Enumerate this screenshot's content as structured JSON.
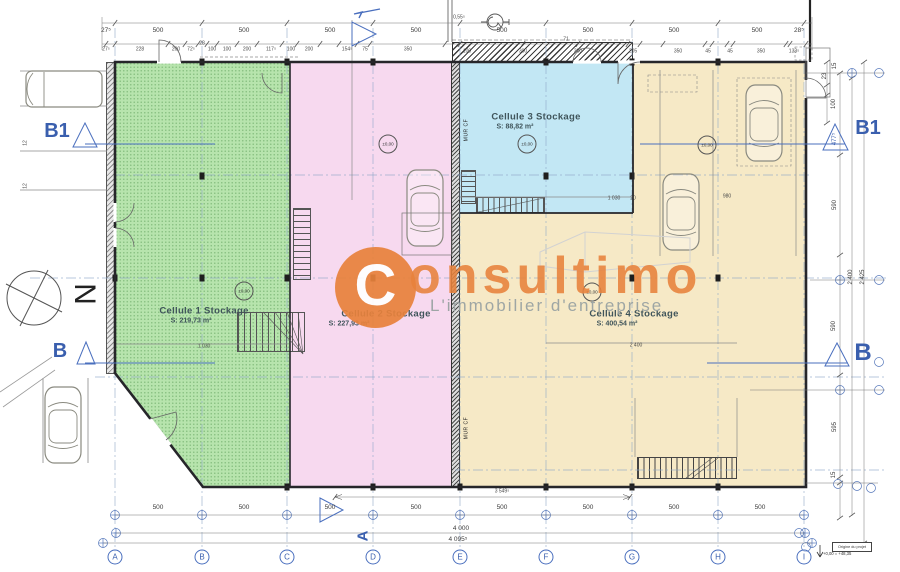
{
  "watermark": {
    "logo_letter": "C",
    "brand": "onsultimo",
    "tagline": "L'immobilier d'entreprise"
  },
  "compass": {
    "letter": "N"
  },
  "levels_label": "±0,00",
  "title_block": {
    "origin_label": "Origine du projet",
    "origin_level": "+0,00 = +48,35"
  },
  "cells": [
    {
      "id": 1,
      "label": "Cellule 1 Stockage",
      "area": "S: 219,73 m²",
      "color": "#b7e4ad"
    },
    {
      "id": 2,
      "label": "Cellule 2 Stockage",
      "area": "S: 227,93 m²",
      "color": "#f7d9ef"
    },
    {
      "id": 3,
      "label": "Cellule 3 Stockage",
      "area": "S: 88,82 m²",
      "color": "#c2e7f4"
    },
    {
      "id": 4,
      "label": "Cellule 4 Stockage",
      "area": "S: 400,54 m²",
      "color": "#f6e9c6"
    }
  ],
  "grid": {
    "letters": [
      "A",
      "B",
      "C",
      "D",
      "E",
      "F",
      "G",
      "H",
      "I"
    ],
    "xs": [
      115,
      202,
      287,
      373,
      460,
      546,
      632,
      718,
      804
    ],
    "y": 557
  },
  "level_badges": [
    [
      244,
      291
    ],
    [
      388,
      144
    ],
    [
      527,
      144
    ],
    [
      707,
      145
    ],
    [
      592,
      292
    ]
  ],
  "labels": [
    {
      "t": "27⁵",
      "x": 106,
      "y": 31,
      "c": "d"
    },
    {
      "t": "500",
      "x": 158,
      "y": 31,
      "c": "d"
    },
    {
      "t": "500",
      "x": 244,
      "y": 31,
      "c": "d"
    },
    {
      "t": "500",
      "x": 330,
      "y": 31,
      "c": "d"
    },
    {
      "t": "500",
      "x": 416,
      "y": 31,
      "c": "d"
    },
    {
      "t": "500",
      "x": 502,
      "y": 31,
      "c": "d"
    },
    {
      "t": "500",
      "x": 588,
      "y": 31,
      "c": "d"
    },
    {
      "t": "500",
      "x": 674,
      "y": 31,
      "c": "d"
    },
    {
      "t": "500",
      "x": 757,
      "y": 31,
      "c": "d"
    },
    {
      "t": "28⁵",
      "x": 799,
      "y": 31,
      "c": "d"
    },
    {
      "t": "27⁵",
      "x": 106,
      "y": 50,
      "c": "t"
    },
    {
      "t": "228",
      "x": 140,
      "y": 50,
      "c": "t"
    },
    {
      "t": "200",
      "x": 176,
      "y": 50,
      "c": "t"
    },
    {
      "t": "72⁵",
      "x": 191,
      "y": 50,
      "c": "t"
    },
    {
      "t": "28",
      "x": 202,
      "y": 44,
      "c": "t"
    },
    {
      "t": "100",
      "x": 212,
      "y": 50,
      "c": "t"
    },
    {
      "t": "100",
      "x": 227,
      "y": 50,
      "c": "t"
    },
    {
      "t": "200",
      "x": 247,
      "y": 50,
      "c": "t"
    },
    {
      "t": "117⁵",
      "x": 271,
      "y": 50,
      "c": "t"
    },
    {
      "t": "100",
      "x": 291,
      "y": 50,
      "c": "t"
    },
    {
      "t": "200",
      "x": 309,
      "y": 50,
      "c": "t"
    },
    {
      "t": "154⁵",
      "x": 347,
      "y": 50,
      "c": "t"
    },
    {
      "t": "75",
      "x": 365,
      "y": 50,
      "c": "t"
    },
    {
      "t": "350",
      "x": 408,
      "y": 50,
      "c": "t"
    },
    {
      "t": "100",
      "x": 467,
      "y": 52,
      "c": "t"
    },
    {
      "t": "300",
      "x": 523,
      "y": 52,
      "c": "t"
    },
    {
      "t": "300",
      "x": 578,
      "y": 52,
      "c": "t"
    },
    {
      "t": "205",
      "x": 633,
      "y": 52,
      "c": "t"
    },
    {
      "t": "350",
      "x": 678,
      "y": 52,
      "c": "t"
    },
    {
      "t": "45",
      "x": 708,
      "y": 52,
      "c": "t"
    },
    {
      "t": "45",
      "x": 730,
      "y": 52,
      "c": "t"
    },
    {
      "t": "350",
      "x": 761,
      "y": 52,
      "c": "t"
    },
    {
      "t": "133⁵",
      "x": 794,
      "y": 52,
      "c": "t"
    },
    {
      "t": "0,55⁵",
      "x": 459,
      "y": 18,
      "c": "t"
    },
    {
      "t": "71",
      "x": 566,
      "y": 40,
      "c": "t"
    },
    {
      "t": "23",
      "x": 825,
      "y": 76,
      "c": "v",
      "r": -90
    },
    {
      "t": "15",
      "x": 835,
      "y": 66,
      "c": "v",
      "r": -90
    },
    {
      "t": "100",
      "x": 834,
      "y": 104,
      "c": "v",
      "r": -90
    },
    {
      "t": "590",
      "x": 835,
      "y": 205,
      "c": "v",
      "r": -90
    },
    {
      "t": "2 400",
      "x": 851,
      "y": 277,
      "c": "v",
      "r": -90
    },
    {
      "t": "2 425",
      "x": 863,
      "y": 277,
      "c": "v",
      "r": -90
    },
    {
      "t": "590",
      "x": 834,
      "y": 326,
      "c": "v",
      "r": -90
    },
    {
      "t": "595",
      "x": 835,
      "y": 427,
      "c": "v",
      "r": -90
    },
    {
      "t": "15",
      "x": 834,
      "y": 475,
      "c": "v",
      "r": -90
    },
    {
      "t": "477⁵",
      "x": 835,
      "y": 139,
      "c": "vb",
      "r": -90
    },
    {
      "t": "12",
      "x": 26,
      "y": 143,
      "c": "t",
      "r": -90
    },
    {
      "t": "12",
      "x": 26,
      "y": 186,
      "c": "t",
      "r": -90
    },
    {
      "t": "1 030",
      "x": 204,
      "y": 347,
      "c": "t"
    },
    {
      "t": "1 030",
      "x": 614,
      "y": 199,
      "c": "t"
    },
    {
      "t": "980",
      "x": 727,
      "y": 197,
      "c": "t"
    },
    {
      "t": "20",
      "x": 633,
      "y": 199,
      "c": "t"
    },
    {
      "t": "2 400",
      "x": 636,
      "y": 346,
      "c": "t"
    },
    {
      "t": "3 549⁵",
      "x": 502,
      "y": 492,
      "c": "t"
    },
    {
      "t": "MUR CF",
      "x": 467,
      "y": 130,
      "c": "mur",
      "r": -90,
      "n": "firewall-label"
    },
    {
      "t": "MUR CF",
      "x": 467,
      "y": 428,
      "c": "mur",
      "r": -90,
      "n": "firewall-label"
    },
    {
      "t": "500",
      "x": 158,
      "y": 508,
      "c": "d"
    },
    {
      "t": "500",
      "x": 244,
      "y": 508,
      "c": "d"
    },
    {
      "t": "500",
      "x": 330,
      "y": 508,
      "c": "d"
    },
    {
      "t": "500",
      "x": 416,
      "y": 508,
      "c": "d"
    },
    {
      "t": "500",
      "x": 502,
      "y": 508,
      "c": "d"
    },
    {
      "t": "500",
      "x": 588,
      "y": 508,
      "c": "d"
    },
    {
      "t": "500",
      "x": 674,
      "y": 508,
      "c": "d"
    },
    {
      "t": "500",
      "x": 760,
      "y": 508,
      "c": "d"
    },
    {
      "t": "4 000",
      "x": 461,
      "y": 529,
      "c": "d"
    },
    {
      "t": "4 095⁵",
      "x": 458,
      "y": 540,
      "c": "d"
    },
    {
      "t": "B1",
      "x": 57,
      "y": 131,
      "c": "sec",
      "n": "section-label-b1-left"
    },
    {
      "t": "B1",
      "x": 868,
      "y": 128,
      "c": "sec",
      "n": "section-label-b1-right"
    },
    {
      "t": "B",
      "x": 60,
      "y": 351,
      "c": "sec",
      "n": "section-label-b-left"
    },
    {
      "t": "B",
      "x": 863,
      "y": 353,
      "c": "seclg",
      "n": "section-label-b-right"
    },
    {
      "t": "A",
      "x": 363,
      "y": 536,
      "c": "seca",
      "r": -90,
      "n": "section-label-a"
    },
    {
      "t": "N",
      "x": 84,
      "y": 294,
      "c": "north",
      "r": 90,
      "n": "north-letter"
    }
  ],
  "cell_label_positions": {
    "c1": {
      "lx": 204,
      "ly": 311,
      "ax": 191,
      "ay": 321
    },
    "c2": {
      "lx": 386,
      "ly": 314,
      "ax": 349,
      "ay": 324
    },
    "c3": {
      "lx": 536,
      "ly": 117,
      "ax": 515,
      "ay": 127
    },
    "c4": {
      "lx": 634,
      "ly": 314,
      "ax": 617,
      "ay": 324
    }
  },
  "plan": {
    "grid_xs": [
      115,
      202,
      287,
      373,
      460,
      546,
      632,
      718,
      804
    ],
    "hguides": [
      [
        115,
        810,
        175
      ],
      [
        30,
        886,
        278
      ],
      [
        95,
        886,
        377
      ],
      [
        455,
        886,
        470
      ]
    ],
    "columns": [
      [
        202,
        62
      ],
      [
        287,
        62
      ],
      [
        373,
        62
      ],
      [
        546,
        62
      ],
      [
        632,
        62
      ],
      [
        718,
        62
      ],
      [
        202,
        176
      ],
      [
        546,
        176
      ],
      [
        632,
        176
      ],
      [
        115,
        278
      ],
      [
        202,
        278
      ],
      [
        287,
        278
      ],
      [
        373,
        278
      ],
      [
        632,
        278
      ],
      [
        718,
        278
      ],
      [
        287,
        487
      ],
      [
        373,
        487
      ],
      [
        460,
        487
      ],
      [
        546,
        487
      ],
      [
        632,
        487
      ],
      [
        718,
        487
      ]
    ],
    "ticks": [
      {
        "y": 23,
        "xs": [
          115,
          202,
          287,
          373,
          460,
          546,
          632,
          718,
          804
        ]
      },
      {
        "y": 44,
        "xs": [
          106,
          115,
          168,
          185,
          198,
          207,
          217,
          237,
          257,
          282,
          297,
          320,
          339,
          357,
          370,
          445,
          460,
          523,
          578,
          628,
          640,
          663,
          705,
          712,
          727,
          733,
          786,
          790,
          806
        ]
      },
      {
        "y": 497,
        "xs": [
          335,
          630
        ]
      },
      {
        "x": 827,
        "ys": [
          62,
          85,
          95,
          123
        ]
      },
      {
        "x": 840,
        "ys": [
          73,
          155,
          255,
          375,
          477,
          483,
          518
        ]
      },
      {
        "x": 852,
        "ys": [
          78,
          515
        ]
      },
      {
        "x": 864,
        "ys": [
          62,
          543
        ]
      }
    ],
    "cross_circles": [
      [
        115,
        515
      ],
      [
        202,
        515
      ],
      [
        287,
        515
      ],
      [
        373,
        515
      ],
      [
        460,
        515
      ],
      [
        546,
        515
      ],
      [
        632,
        515
      ],
      [
        718,
        515
      ],
      [
        804,
        515
      ],
      [
        852,
        73
      ],
      [
        840,
        280
      ],
      [
        840,
        390
      ],
      [
        116,
        533
      ],
      [
        805,
        533
      ],
      [
        103,
        543
      ],
      [
        812,
        543
      ]
    ],
    "circles": [
      [
        879,
        73
      ],
      [
        879,
        280
      ],
      [
        879,
        362
      ],
      [
        879,
        390
      ],
      [
        838,
        484
      ],
      [
        857,
        486
      ],
      [
        871,
        488
      ],
      [
        799,
        533
      ],
      [
        806,
        547
      ]
    ]
  }
}
